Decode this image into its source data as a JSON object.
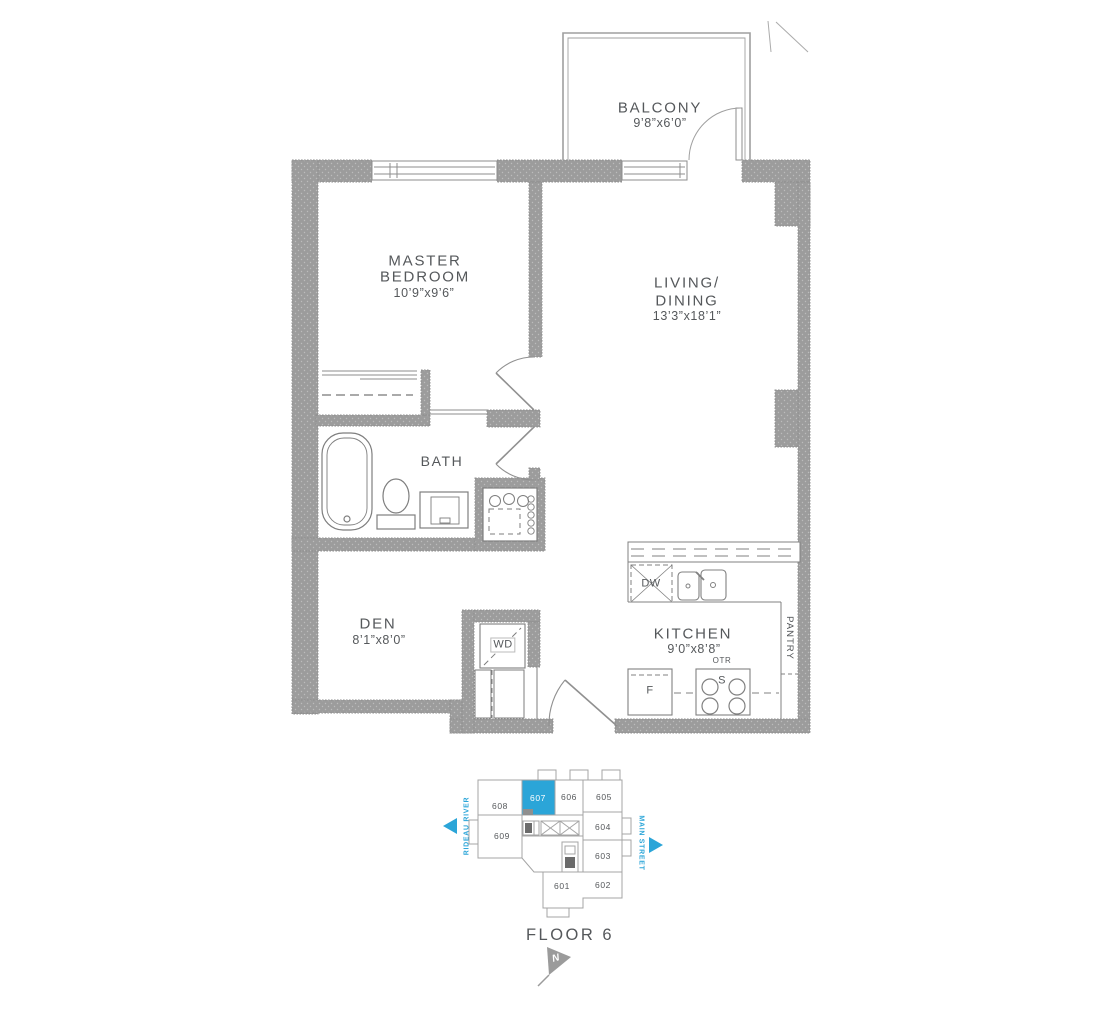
{
  "meta": {
    "floor_label": "FLOOR 6",
    "north_label": "N"
  },
  "rooms": {
    "balcony": {
      "name": "BALCONY",
      "dims": "9’8”x6’0”"
    },
    "master_bedroom": {
      "line1": "MASTER",
      "line2": "BEDROOM",
      "dims": "10’9”x9’6”"
    },
    "living_dining": {
      "line1": "LIVING/",
      "line2": "DINING",
      "dims": "13’3”x18’1”"
    },
    "bath": {
      "name": "BATH"
    },
    "den": {
      "name": "DEN",
      "dims": "8’1”x8’0”"
    },
    "kitchen": {
      "name": "KITCHEN",
      "dims": "9’0”x8’8”"
    },
    "pantry": {
      "name": "PANTRY"
    }
  },
  "fixtures": {
    "washer_dryer": "WD",
    "dishwasher": "DW",
    "fridge": "F",
    "stove": "S",
    "over_the_range": "OTR"
  },
  "keyplan": {
    "highlighted_unit": "607",
    "units": {
      "u601": "601",
      "u602": "602",
      "u603": "603",
      "u604": "604",
      "u605": "605",
      "u606": "606",
      "u607": "607",
      "u608": "608",
      "u609": "609"
    },
    "streets": {
      "left": "RIDEAU RIVER",
      "right": "MAIN STREET"
    }
  },
  "colors": {
    "wall_gray": "#9C9C9C",
    "line_gray": "#8D8D8D",
    "text_gray": "#55585B",
    "accent_blue": "#2BA5D8"
  }
}
